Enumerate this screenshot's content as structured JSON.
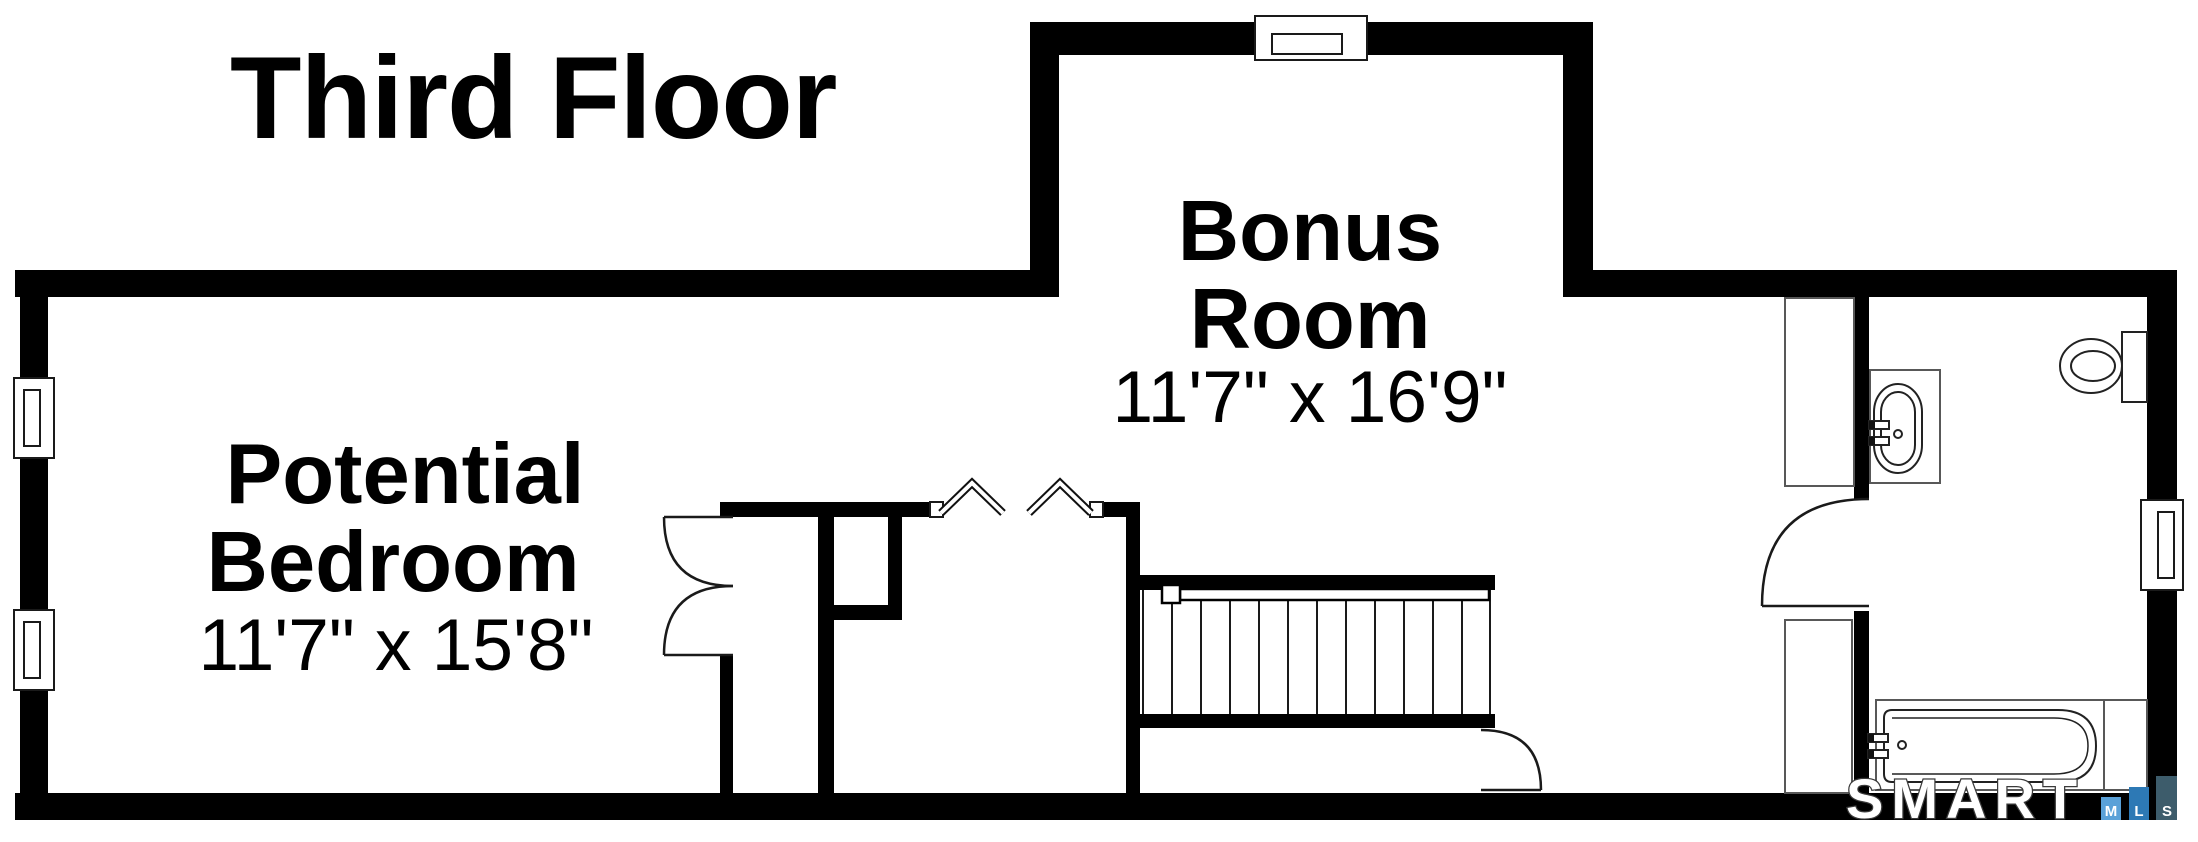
{
  "title": "Third Floor",
  "rooms": {
    "bedroom": {
      "name_line1": "Potential",
      "name_line2": "Bedroom",
      "dimensions": "11'7\" x 15'8\""
    },
    "bonus": {
      "name_line1": "Bonus",
      "name_line2": "Room",
      "dimensions": "11'7\" x 16'9\""
    }
  },
  "plan_symbols": {
    "window_count": 4,
    "door_count": 4,
    "stair_tread_count": 12,
    "fixtures": [
      "sink-vanity",
      "toilet",
      "bathtub",
      "closet",
      "closet",
      "chimney-chase"
    ]
  },
  "logo": {
    "brand": "SMART",
    "squares": [
      {
        "letter": "M",
        "color": "#5aa1d8"
      },
      {
        "letter": "L",
        "color": "#2d79b5"
      },
      {
        "letter": "S",
        "color": "#3d5c6b"
      }
    ]
  },
  "colors": {
    "wall": "#000000",
    "background": "#ffffff"
  }
}
